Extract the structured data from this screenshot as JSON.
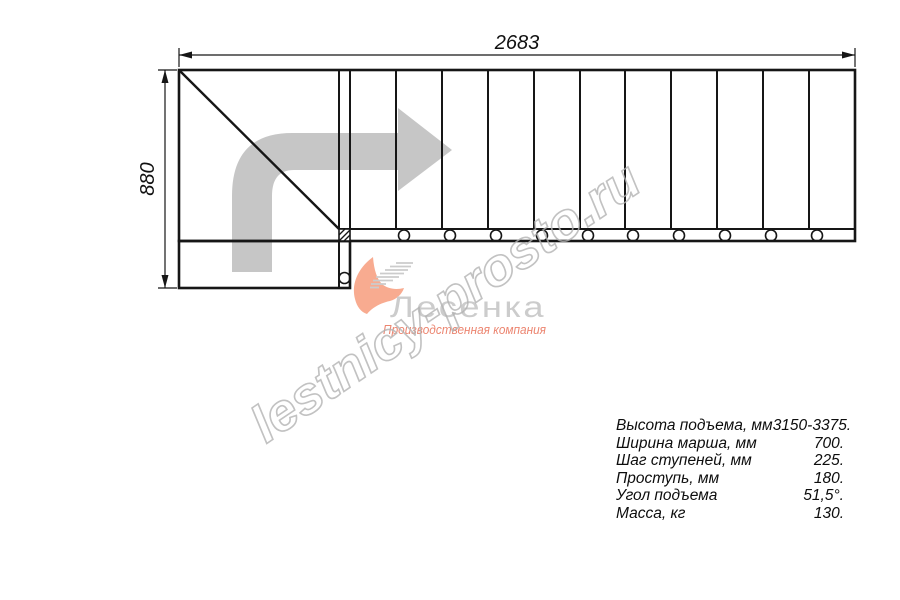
{
  "drawing": {
    "width_label": "2683",
    "height_label": "880"
  },
  "watermark": {
    "text": "lestnicy-prosto.ru"
  },
  "logo": {
    "name": "Лесенка",
    "tagline": "Производственная компания"
  },
  "specs": {
    "rows": [
      {
        "label": "Высота подъема, мм",
        "value": "3150-3375."
      },
      {
        "label": "Ширина марша, мм",
        "value": "700."
      },
      {
        "label": "Шаг ступеней, мм",
        "value": "225."
      },
      {
        "label": "Проступь, мм",
        "value": "180."
      },
      {
        "label": "Угол подъема",
        "value": "51,5°."
      },
      {
        "label": "Масса, кг",
        "value": "130."
      }
    ]
  },
  "colors": {
    "line": "#161616",
    "direction_arrow": "#c6c6c6",
    "watermark_stroke": "#b3b3b3",
    "logo_name": "#cccccc",
    "logo_tagline": "#ec8570",
    "logo_swoosh": "#f8ab90"
  }
}
